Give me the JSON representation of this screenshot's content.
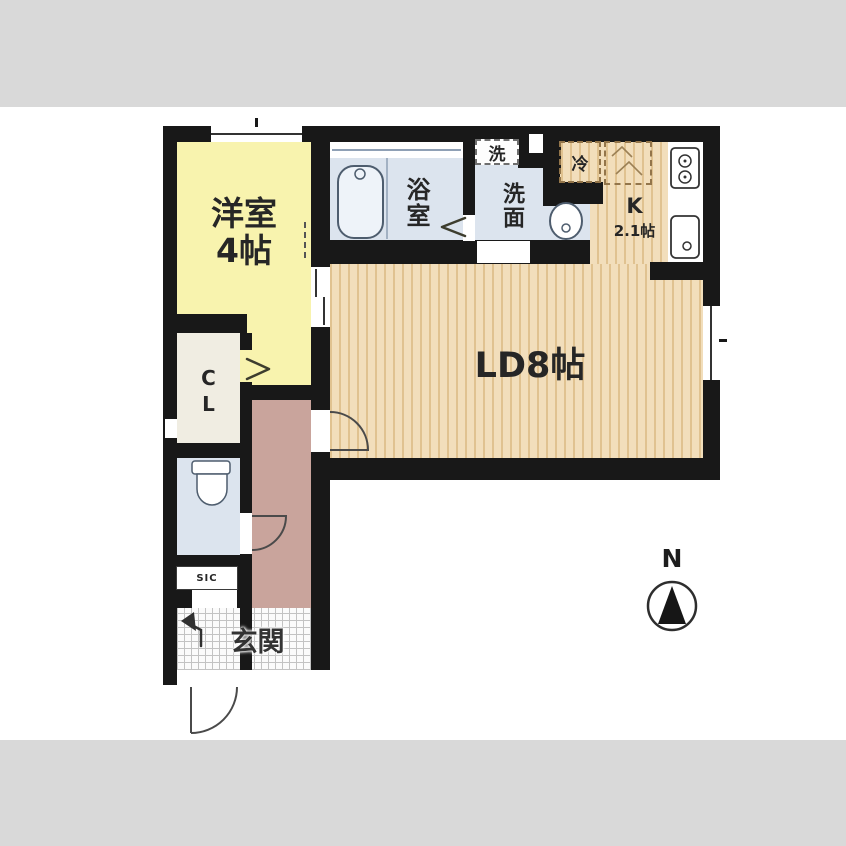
{
  "labels": {
    "western_room": {
      "name": "洋室",
      "size": "4帖"
    },
    "bathroom": "浴室",
    "laundry": "洗",
    "washroom": "洗面",
    "fridge": "冷",
    "kitchen": {
      "abbr": "K",
      "size": "2.1帖"
    },
    "living_dining": "LD8帖",
    "closet": "CL",
    "shoe_closet": "SIC",
    "entrance": "玄関",
    "compass_north": "N"
  },
  "colors": {
    "wall": "#181818",
    "tatami": "#f8f3ae",
    "wood_floor": "#f2debb",
    "wet_area": "#dce4ee",
    "closet": "#f0ede2",
    "corridor": "#c9a49c",
    "matte": "#d9d9d9",
    "background": "#ffffff"
  }
}
